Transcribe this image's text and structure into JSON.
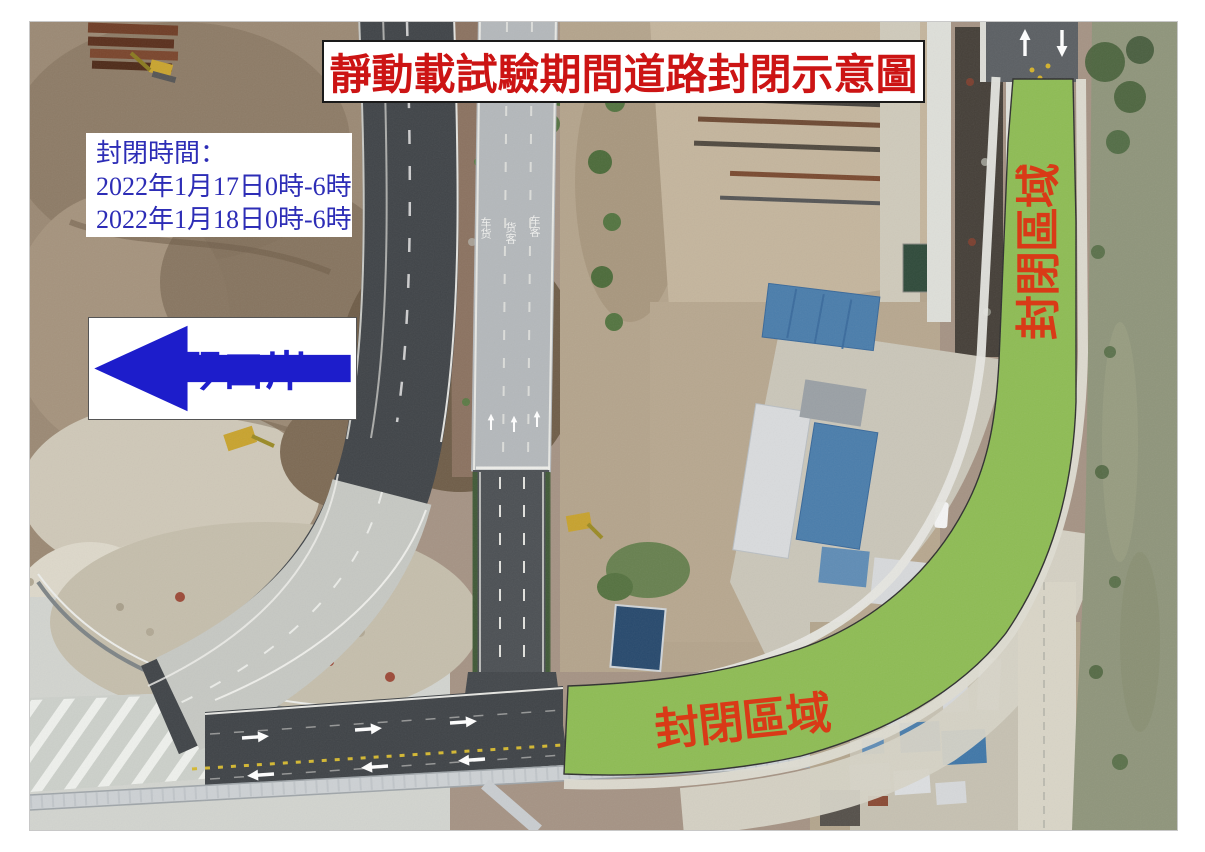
{
  "title_box": {
    "text": "靜動載試驗期間道路封閉示意圖",
    "text_color": "#cc1414",
    "background": "#ffffff"
  },
  "closure_time_box": {
    "heading": "封閉時間：",
    "dates": [
      "2022年1月17日0時-6時",
      "2022年1月18日0時-6時"
    ],
    "text_color": "#2d2db6",
    "background": "#ffffff"
  },
  "port_direction_box": {
    "text": "橫琴口岸",
    "icon": "left-arrow-icon",
    "text_color": "#1f1fcc",
    "background": "#ffffff"
  },
  "closed_zone": {
    "bottom_label": "封閉區域",
    "right_label": "封閉區域",
    "zone_fill": "#8ebc54",
    "zone_outline": "#2f2f2f",
    "label_color": "#d93a17"
  },
  "road_surface_markings": {
    "lane_labels": [
      "车货",
      "货客",
      "车客"
    ],
    "arrow_icons": [
      "right-arrow-icon",
      "left-arrow-icon",
      "up-arrow-icon",
      "down-arrow-icon"
    ]
  }
}
